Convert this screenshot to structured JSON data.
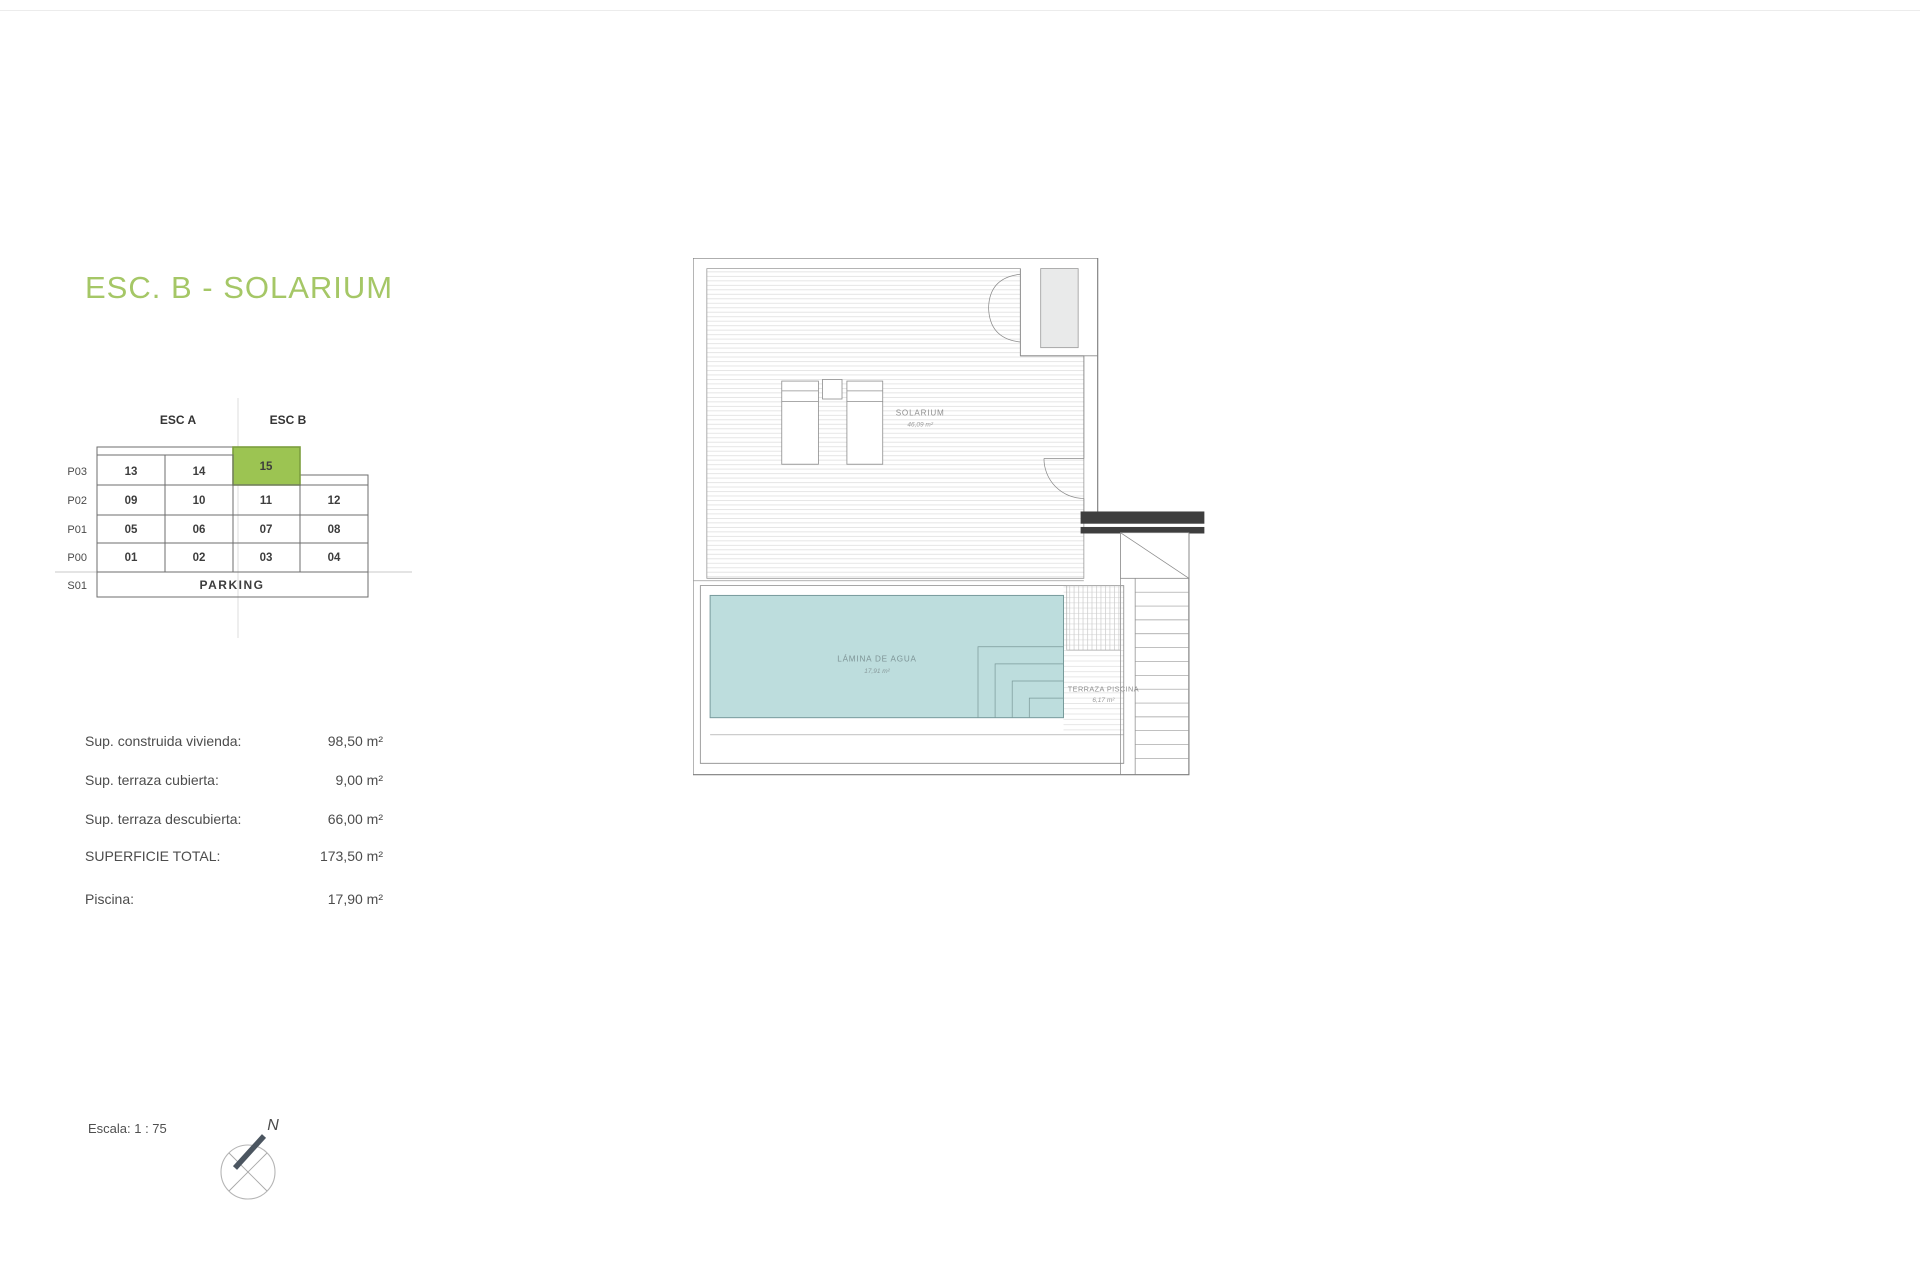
{
  "page": {
    "title": "ESC. B - SOLARIUM",
    "title_color": "#a5c766"
  },
  "matrix": {
    "headers": {
      "esc_a": "ESC A",
      "esc_b": "ESC B"
    },
    "row_labels": [
      "P03",
      "P02",
      "P01",
      "P00",
      "S01"
    ],
    "cells": {
      "p03": [
        "13",
        "14",
        "15"
      ],
      "p02": [
        "09",
        "10",
        "11",
        "12"
      ],
      "p01": [
        "05",
        "06",
        "07",
        "08"
      ],
      "p00": [
        "01",
        "02",
        "03",
        "04"
      ],
      "s01": "PARKING"
    },
    "highlighted_unit": "15",
    "highlight_color": "#9cc452",
    "highlight_border": "#7c9e3e"
  },
  "specs": {
    "rows": [
      {
        "label": "Sup. construida vivienda:",
        "value": "98,50 m²"
      },
      {
        "label": "Sup. terraza cubierta:",
        "value": "9,00 m²"
      },
      {
        "label": "Sup. terraza descubierta:",
        "value": "66,00 m²"
      },
      {
        "label": "SUPERFICIE TOTAL:",
        "value": "173,50 m²"
      },
      {
        "label": "Piscina:",
        "value": "17,90 m²"
      }
    ]
  },
  "plan": {
    "rooms": [
      {
        "name": "SOLARIUM",
        "area": "46,09 m²"
      },
      {
        "name": "LÁMINA DE AGUA",
        "area": "17,91 m²"
      },
      {
        "name": "TERRAZA PISCINA",
        "area": "6,17 m²"
      }
    ],
    "pool_color": "#bddddd"
  },
  "footer": {
    "scale_label": "Escala: 1 : 75",
    "north_label": "N"
  }
}
